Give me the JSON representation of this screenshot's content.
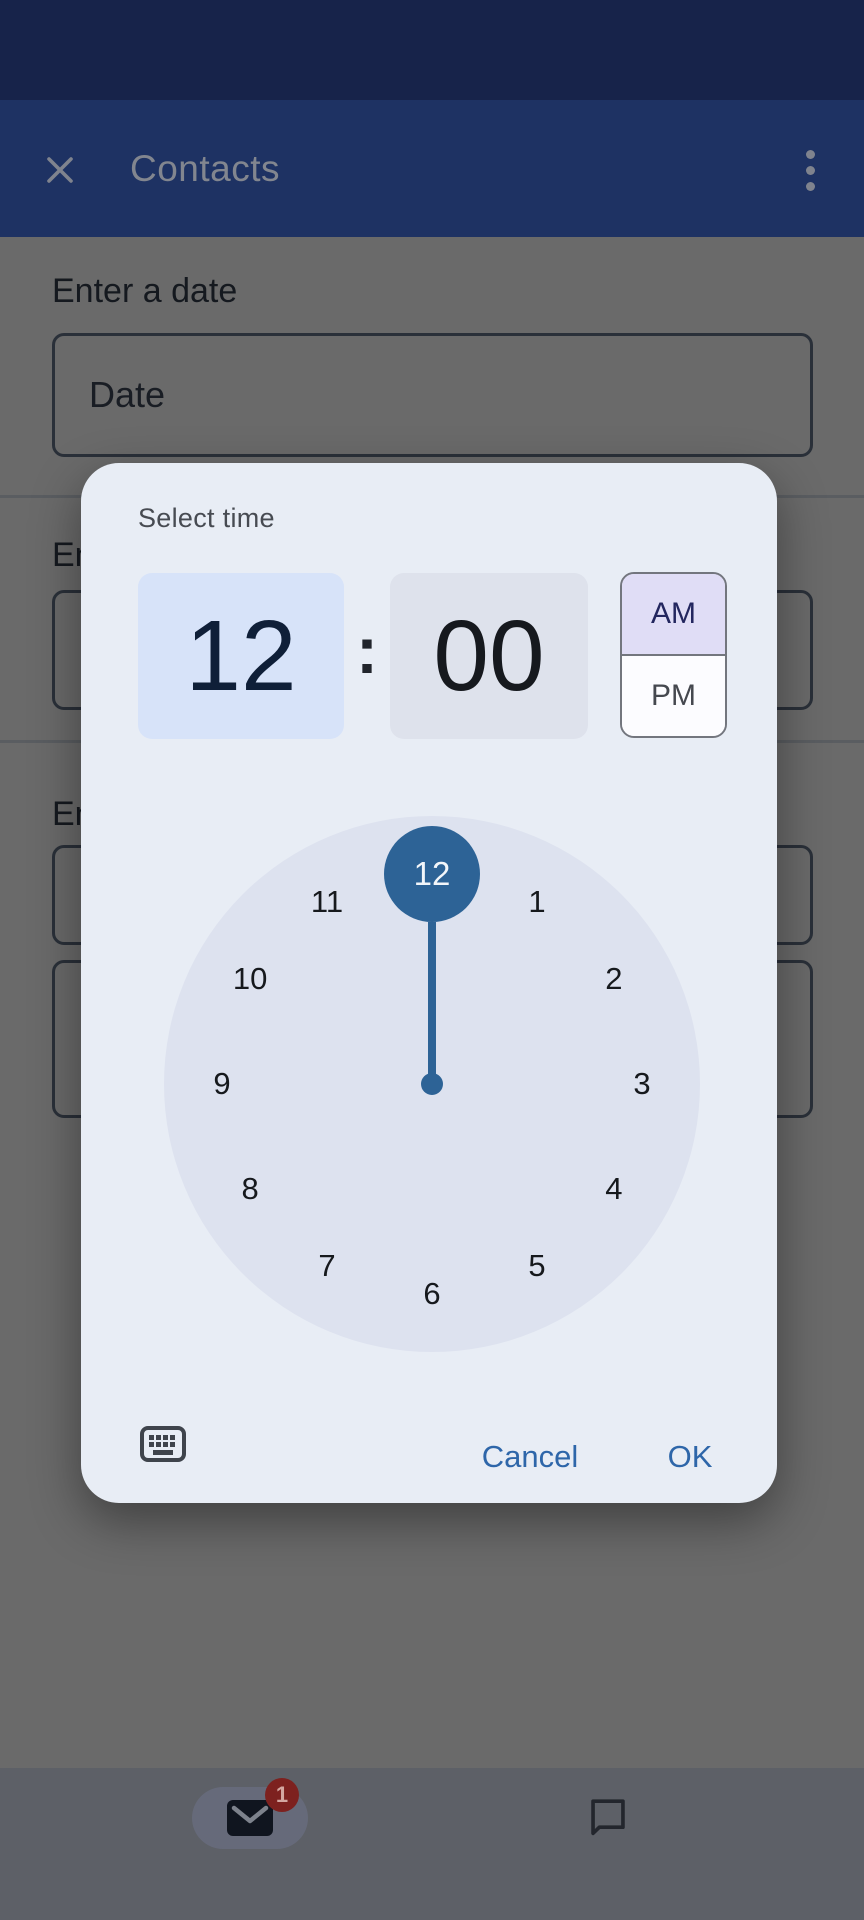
{
  "app_bar": {
    "title": "Contacts"
  },
  "background_form": {
    "date_label": "Enter a date",
    "date_field_value": "Date",
    "partial_label_top": "En",
    "partial_label_bottom": "En"
  },
  "dialog": {
    "title": "Select time",
    "hour": "12",
    "minute": "00",
    "time_separator": ":",
    "am_label": "AM",
    "pm_label": "PM",
    "selected_period": "AM",
    "selected_hour": "12",
    "clock_numbers": [
      "12",
      "1",
      "2",
      "3",
      "4",
      "5",
      "6",
      "7",
      "8",
      "9",
      "10",
      "11"
    ],
    "cancel_label": "Cancel",
    "ok_label": "OK"
  },
  "bottom_nav": {
    "mail_badge_count": "1"
  },
  "colors": {
    "status_bar_bg": "#17234a",
    "app_bar_bg": "#1e3263",
    "scrim_gray": "#6a6a6a",
    "dialog_bg": "#e8edf5",
    "dial_bg": "#dde2ef",
    "hour_box_bg": "#d7e3f9",
    "minute_box_bg": "#dee2ec",
    "am_bg": "#e0ddf6",
    "accent_blue": "#2d6396",
    "button_blue": "#2e66a9",
    "badge_red": "#7d211f",
    "nav_bar_bg": "#5d6067"
  }
}
